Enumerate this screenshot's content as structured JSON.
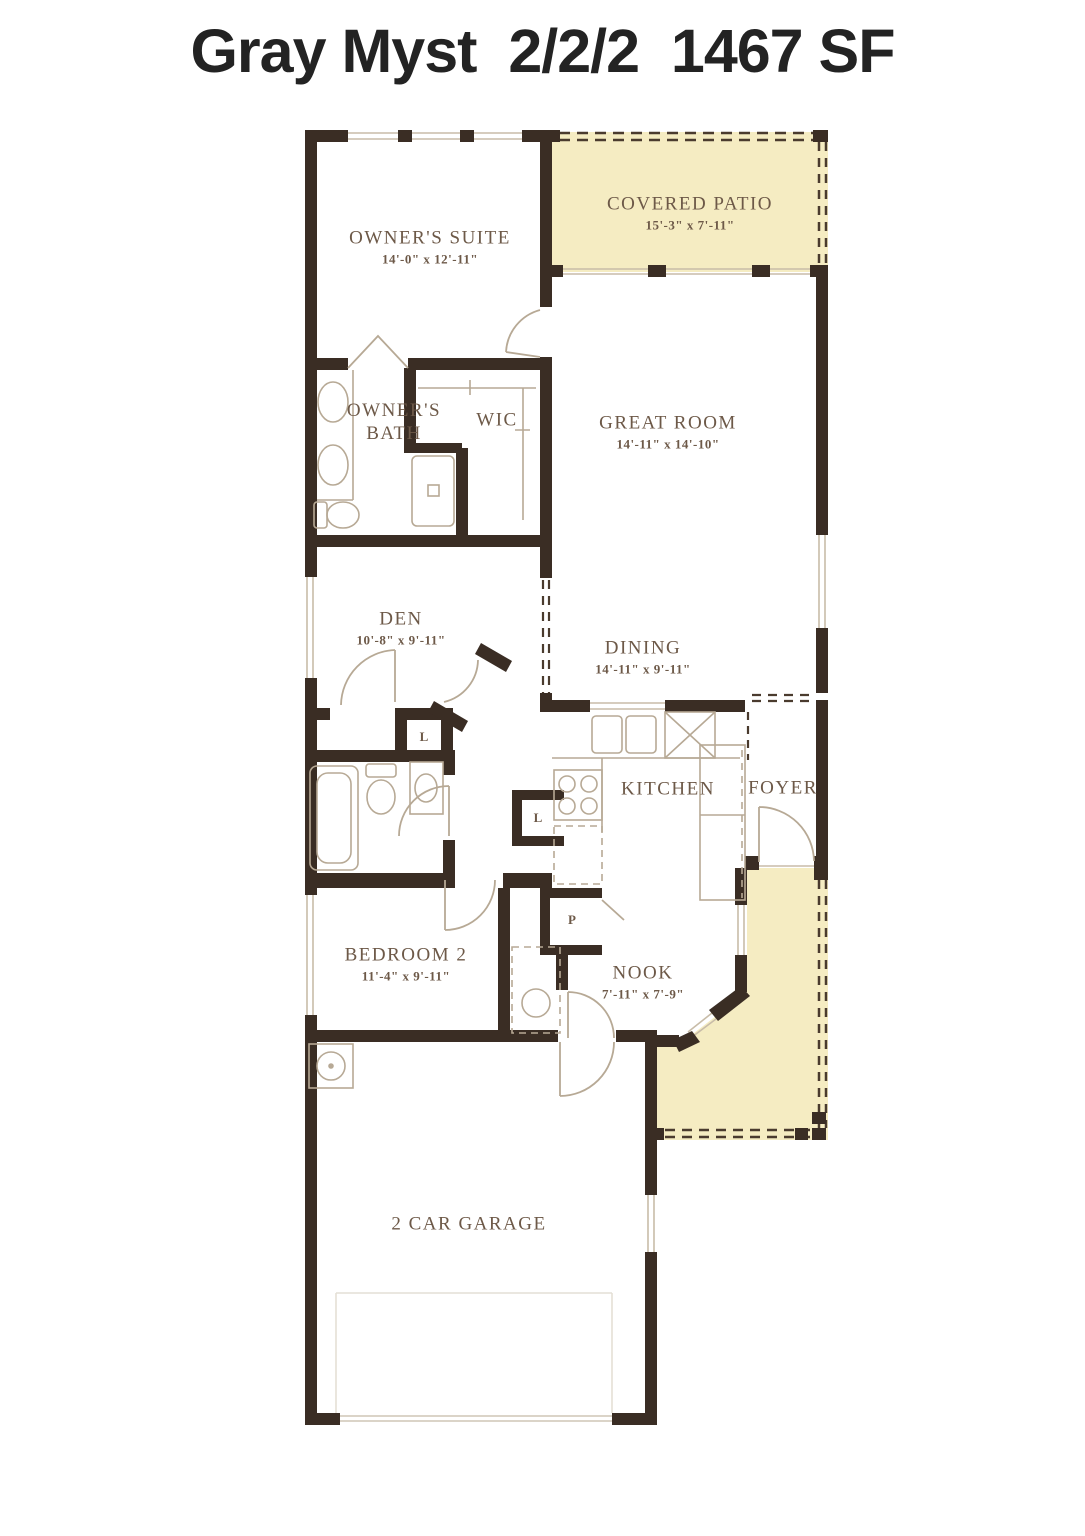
{
  "title": "Gray Myst  2/2/2  1467 SF",
  "rooms": {
    "owners_suite": {
      "name": "OWNER'S SUITE",
      "dims": "14'-0\" x 12'-11\""
    },
    "covered_patio": {
      "name": "COVERED PATIO",
      "dims": "15'-3\" x 7'-11\""
    },
    "owners_bath": {
      "name": "OWNER'S BATH"
    },
    "wic": {
      "name": "WIC"
    },
    "great_room": {
      "name": "GREAT ROOM",
      "dims": "14'-11\" x 14'-10\""
    },
    "den": {
      "name": "DEN",
      "dims": "10'-8\" x 9'-11\""
    },
    "dining": {
      "name": "DINING",
      "dims": "14'-11\" x 9'-11\""
    },
    "kitchen": {
      "name": "KITCHEN"
    },
    "foyer": {
      "name": "FOYER"
    },
    "bedroom_2": {
      "name": "BEDROOM 2",
      "dims": "11'-4\" x 9'-11\""
    },
    "nook": {
      "name": "NOOK",
      "dims": "7'-11\" x 7'-9\""
    },
    "garage": {
      "name": "2 CAR GARAGE"
    }
  },
  "closets": {
    "linen_1": "L",
    "linen_2": "L",
    "pantry": "P"
  },
  "colors": {
    "wall": "#3a2d24",
    "patio_fill": "#f5ecc2",
    "label_text": "#6d5948",
    "fixture_line": "#b7a995",
    "title_text": "#232323"
  }
}
